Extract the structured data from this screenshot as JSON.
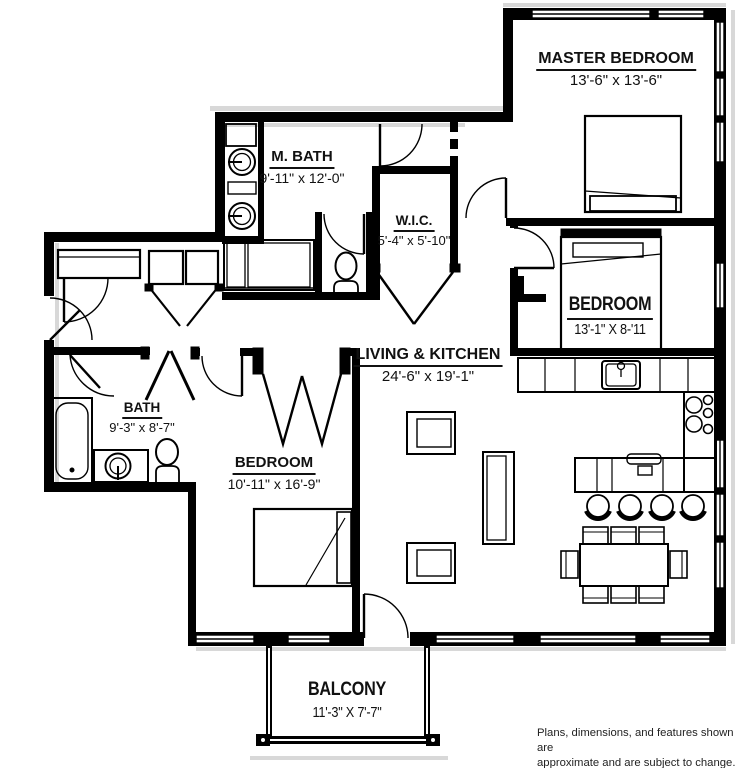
{
  "plan": {
    "rooms": [
      {
        "id": "master-bedroom",
        "name": "MASTER BEDROOM",
        "dims": "13'-6\" x 13'-6\""
      },
      {
        "id": "master-bath",
        "name": "M. BATH",
        "dims": "9'-11\" x 12'-0\""
      },
      {
        "id": "walk-in-closet",
        "name": "W.I.C.",
        "dims": "5'-4\" x 5'-10\""
      },
      {
        "id": "bedroom-right",
        "name": "BEDROOM",
        "dims": "13'-1\" X 8-'11"
      },
      {
        "id": "living-kitchen",
        "name": "LIVING & KITCHEN",
        "dims": "24'-6\" x 19'-1\""
      },
      {
        "id": "bath",
        "name": "BATH",
        "dims": "9'-3\" x 8'-7\""
      },
      {
        "id": "bedroom-left",
        "name": "BEDROOM",
        "dims": "10'-11\" x 16'-9\""
      },
      {
        "id": "balcony",
        "name": "BALCONY",
        "dims": "11'-3\" X 7'-7\""
      }
    ],
    "disclaimer": {
      "line1": "Plans, dimensions, and features shown are",
      "line2": "approximate and are subject to change."
    },
    "colors": {
      "walls": "#000000",
      "background": "#ffffff",
      "shadow": "#d8d8d8",
      "text": "#111111"
    }
  }
}
